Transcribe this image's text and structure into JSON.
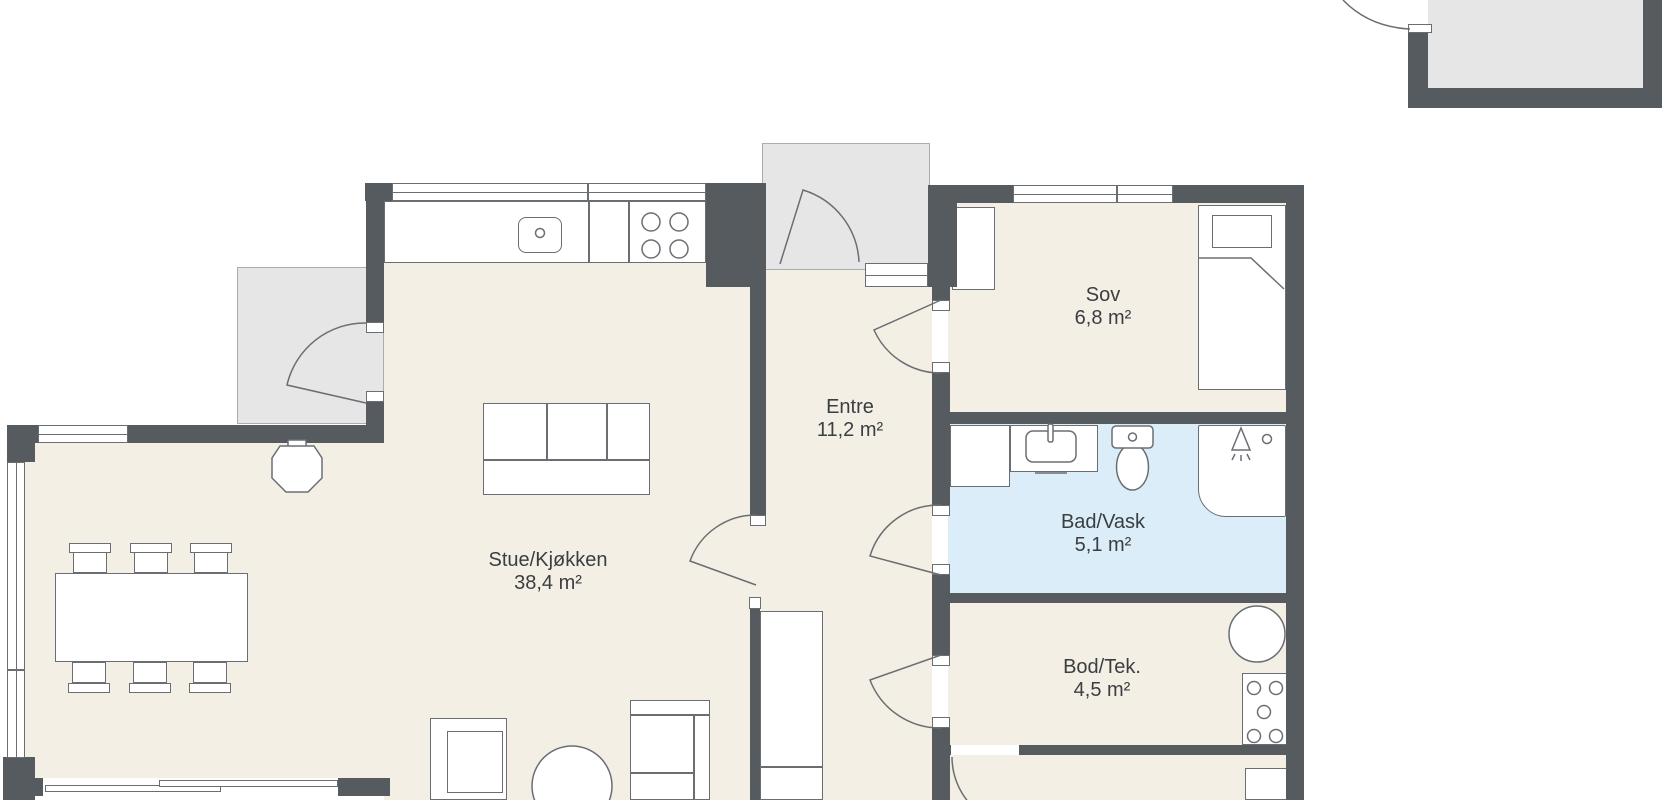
{
  "plan": {
    "rooms": [
      {
        "name": "Stue/Kjøkken",
        "area": "38,4 m²"
      },
      {
        "name": "Entre",
        "area": "11,2 m²"
      },
      {
        "name": "Sov",
        "area": "6,8 m²"
      },
      {
        "name": "Bad/Vask",
        "area": "5,1 m²"
      },
      {
        "name": "Bod/Tek.",
        "area": "4,5 m²"
      }
    ],
    "colors": {
      "wall": "#565b60",
      "floor": "#f4efe5",
      "bath": "#daedf8",
      "outdoor": "#e6e6e6",
      "line": "#6a6e73"
    }
  }
}
